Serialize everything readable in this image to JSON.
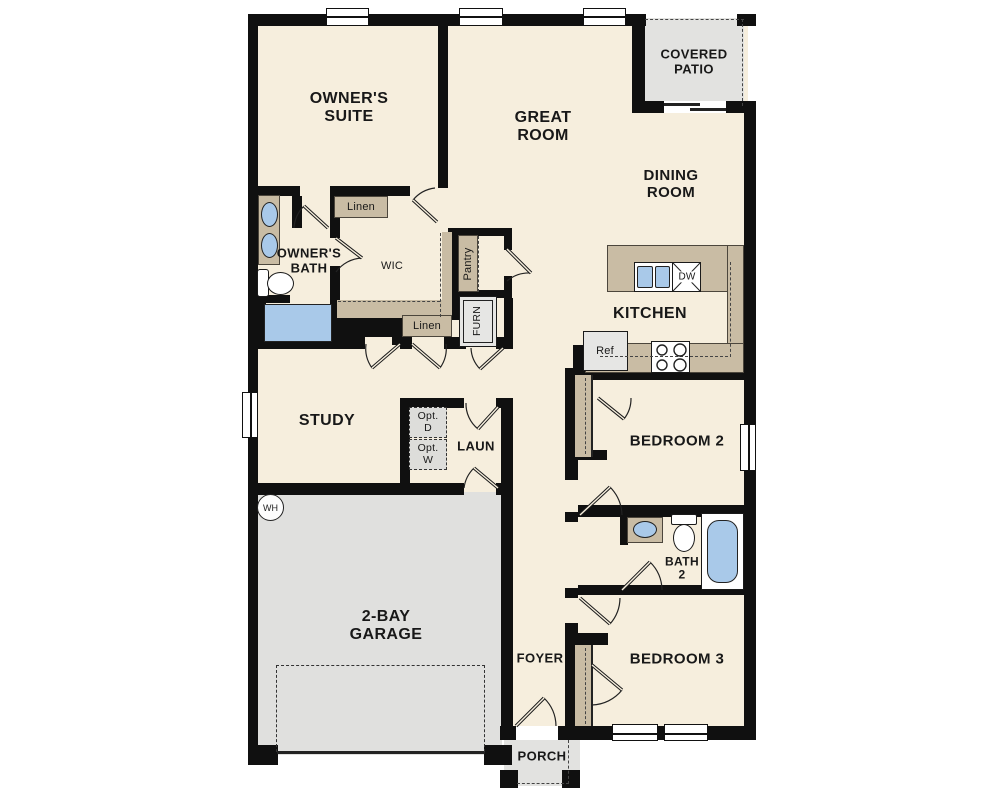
{
  "rooms": {
    "owners_suite": "OWNER'S\nSUITE",
    "great_room": "GREAT\nROOM",
    "covered_patio": "COVERED\nPATIO",
    "dining_room": "DINING\nROOM",
    "kitchen": "KITCHEN",
    "owners_bath": "OWNER'S\nBATH",
    "wic": "WIC",
    "study": "STUDY",
    "laundry": "LAUN",
    "garage": "2-BAY\nGARAGE",
    "bedroom2": "BEDROOM 2",
    "bath2": "BATH\n2",
    "bedroom3": "BEDROOM 3",
    "foyer": "FOYER",
    "porch": "PORCH"
  },
  "features": {
    "linen_upper": "Linen",
    "linen_lower": "Linen",
    "pantry": "Pantry",
    "furnace": "FURN",
    "refrigerator": "Ref",
    "dishwasher": "DW",
    "water_heater": "WH",
    "opt_dryer": "Opt.\nD",
    "opt_washer": "Opt.\nW"
  },
  "colors": {
    "wall": "#101010",
    "floor": "#f6eedd",
    "exterior_concrete": "#e2e2e0",
    "casework_tan": "#c9bca4",
    "fixture_blue": "#a9c9e9"
  }
}
